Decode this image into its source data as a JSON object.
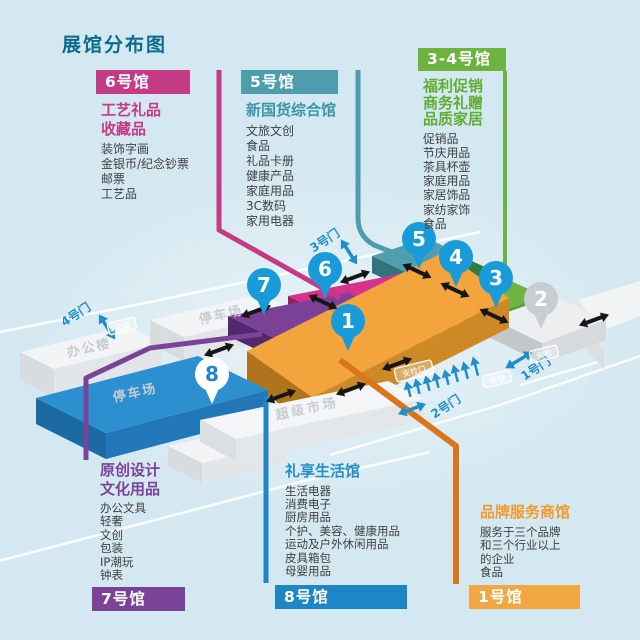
{
  "page": {
    "title": "展馆分布图"
  },
  "palette": {
    "background": "#d4e8f1",
    "title_text": "#0d6b8d",
    "hall1_orange": "#f4a43c",
    "hall2_gray": "#eceef0",
    "hall3_green": "#6db440",
    "hall4_dark_green": "#2e7d3c",
    "hall5_teal": "#4f9fae",
    "hall6_magenta": "#d5318d",
    "hall7_purple": "#7b4196",
    "hall8_blue": "#2b8fd0",
    "pin_blue": "#189bd8",
    "gate_text_blue": "#1e8fcb"
  },
  "sections": {
    "hall6": {
      "tag": "6号馆",
      "title_lines": [
        "工艺礼品",
        "收藏品"
      ],
      "items": [
        "装饰字画",
        "金银币/纪念钞票",
        "邮票",
        "工艺品"
      ]
    },
    "hall5": {
      "tag": "5号馆",
      "title_lines": [
        "新国货综合馆"
      ],
      "items": [
        "文旅文创",
        "食品",
        "礼品卡册",
        "健康产品",
        "家庭用品",
        "3C数码",
        "家用电器"
      ]
    },
    "hall34": {
      "tag": "3-4号馆",
      "title_lines": [
        "福利促销",
        "商务礼赠",
        "品质家居"
      ],
      "items": [
        "促销品",
        "节庆用品",
        "茶具杯壶",
        "家庭用品",
        "家居饰品",
        "家纺家饰",
        "食品"
      ]
    },
    "hall7": {
      "tag": "7号馆",
      "title_lines": [
        "原创设计",
        "文化用品"
      ],
      "items": [
        "办公文具",
        "轻奢",
        "文创",
        "包装",
        "IP潮玩",
        "钟表"
      ]
    },
    "hall8": {
      "tag": "8号馆",
      "title_lines": [
        "礼享生活馆"
      ],
      "items": [
        "生活电器",
        "消费电子",
        "厨房用品",
        "个护、美容、健康用品",
        "运动及户外休闲用品",
        "皮具箱包",
        "母婴用品"
      ]
    },
    "hall1": {
      "tag": "1号馆",
      "title_lines": [
        "品牌服务商馆"
      ],
      "items": [
        "服务于三个品牌",
        "和三个行业以上",
        "的企业",
        "食品"
      ]
    }
  },
  "map": {
    "pin_labels": [
      "1",
      "2",
      "3",
      "4",
      "5",
      "6",
      "7",
      "8"
    ],
    "buildings": [
      "办公楼",
      "停车场",
      "停车场",
      "超级市场"
    ],
    "gates": {
      "g1": "1号门",
      "g2": "2号门",
      "g3": "3号门",
      "g4": "4号门"
    },
    "badges": {
      "gate4": "安检",
      "gate2_left": "安检口",
      "gate2_right": "安检",
      "gate1": "安检"
    }
  }
}
